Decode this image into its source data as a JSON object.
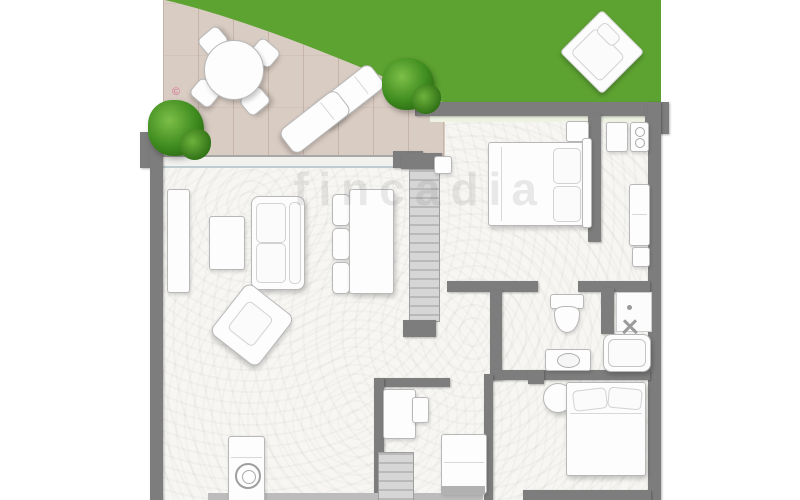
{
  "watermark": {
    "text": "fincadia",
    "mark": "©"
  },
  "palette": {
    "wall": "#7d7d7d",
    "grass": "#5da331",
    "deck": "#d9ccc3",
    "deck_line": "#c3b3a7",
    "floor": "#f7f6f3",
    "furniture_fill": "#fdfdfd",
    "furniture_line": "#b8b8b8",
    "plant_green": "#3d8a1e",
    "hatch_gray": "#bdbdbd",
    "pink_mark": "#d86e8c"
  },
  "plan": {
    "type": "apartment-floor-plan",
    "outdoor": {
      "areas": [
        "garden-lawn",
        "wood-deck-terrace"
      ],
      "symbols": [
        "round-table",
        "terrace-chair",
        "terrace-chair",
        "terrace-chair",
        "terrace-chair",
        "sun-lounger",
        "sun-lounger",
        "potted-plant",
        "potted-plant",
        "garden-daybed"
      ]
    },
    "rooms": [
      {
        "name": "living-dining-room",
        "symbols": [
          "sideboard",
          "coffee-table",
          "sofa",
          "armchair",
          "dining-chair",
          "dining-chair",
          "dining-chair",
          "dining-table",
          "wardrobe-divider"
        ]
      },
      {
        "name": "bedroom-1",
        "symbols": [
          "double-bed",
          "pillow",
          "pillow",
          "nightstand",
          "nightstand"
        ]
      },
      {
        "name": "utility-kitchen-nook",
        "symbols": [
          "sink-unit",
          "hob-unit",
          "cabinet",
          "cabinet"
        ]
      },
      {
        "name": "bathroom",
        "symbols": [
          "toilet",
          "washbasin",
          "bathtub",
          "shower",
          "tap-cross"
        ]
      },
      {
        "name": "bedroom-2",
        "symbols": [
          "double-bed",
          "pillow",
          "pillow",
          "round-stool"
        ]
      },
      {
        "name": "hallway",
        "symbols": [
          "shelf",
          "hatched-cabinet",
          "closet"
        ]
      },
      {
        "name": "kitchen-area",
        "symbols": [
          "tall-unit-with-washer",
          "counter-edge"
        ]
      }
    ]
  }
}
